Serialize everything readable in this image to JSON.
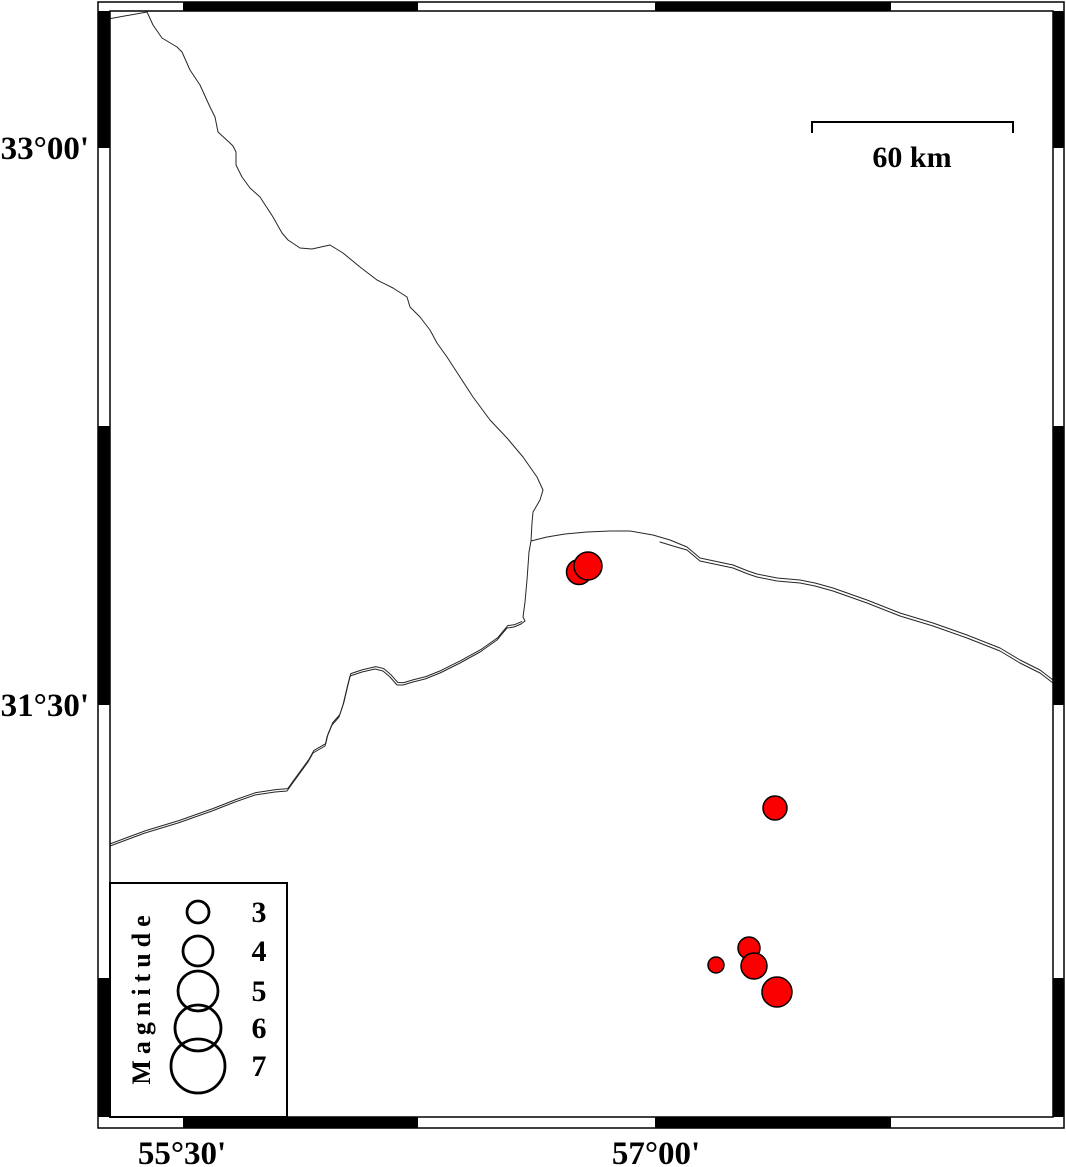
{
  "map": {
    "width": 1066,
    "height": 1167,
    "background": "#ffffff",
    "frame": {
      "outer": {
        "x": 98,
        "y": 2,
        "w": 966,
        "h": 1126
      },
      "inner": {
        "x": 110,
        "y": 11,
        "w": 943,
        "h": 1106
      },
      "top_black_segments": [
        [
          183,
          418
        ],
        [
          655,
          891
        ]
      ],
      "bottom_black_segments": [
        [
          183,
          418
        ],
        [
          655,
          891
        ]
      ],
      "left_black_segments": [
        [
          11,
          148
        ],
        [
          426,
          705
        ],
        [
          978,
          1117
        ]
      ],
      "right_black_segments": [
        [
          11,
          148
        ],
        [
          426,
          705
        ],
        [
          978,
          1117
        ]
      ]
    },
    "axes": {
      "left_labels": [
        {
          "label": "33°00'",
          "y": 148
        },
        {
          "label": "31°30'",
          "y": 705
        }
      ],
      "bottom_labels": [
        {
          "label": "55°30'",
          "x": 182
        },
        {
          "label": "57°00'",
          "x": 656
        }
      ]
    },
    "scalebar": {
      "label": "60 km",
      "x1": 812,
      "x2": 1013,
      "y": 122,
      "tick_len": 11,
      "label_x": 912,
      "label_y": 167
    },
    "legend": {
      "title": "Magnitude",
      "box": {
        "x": 110,
        "y": 883,
        "w": 177,
        "h": 234
      },
      "title_x": 150,
      "title_y": 997,
      "circle_cx": 198,
      "value_x": 259,
      "entries": [
        {
          "label": "3",
          "cy": 912,
          "r": 11
        },
        {
          "label": "4",
          "cy": 951,
          "r": 15
        },
        {
          "label": "5",
          "cy": 991,
          "r": 20
        },
        {
          "label": "6",
          "cy": 1028,
          "r": 23
        },
        {
          "label": "7",
          "cy": 1066,
          "r": 27
        }
      ]
    },
    "events": {
      "fill_color": "#fb0000",
      "outline_color": "#000000",
      "points": [
        {
          "x": 579,
          "y": 572,
          "r": 12.5
        },
        {
          "x": 588,
          "y": 566,
          "r": 14
        },
        {
          "x": 775,
          "y": 808,
          "r": 12
        },
        {
          "x": 716,
          "y": 965,
          "r": 8
        },
        {
          "x": 749,
          "y": 948,
          "r": 11
        },
        {
          "x": 754,
          "y": 966,
          "r": 13
        },
        {
          "x": 777,
          "y": 992,
          "r": 15
        }
      ]
    },
    "coastlines": {
      "color": "#262626",
      "paths": [
        {
          "name": "boundary-northwest",
          "points": [
            [
              108,
              19
            ],
            [
              147,
              12
            ],
            [
              153,
              25
            ],
            [
              162,
              38
            ],
            [
              177,
              47
            ],
            [
              182,
              52
            ],
            [
              190,
              70
            ],
            [
              200,
              85
            ],
            [
              210,
              107
            ],
            [
              215,
              117
            ],
            [
              218,
              132
            ],
            [
              230,
              143
            ],
            [
              233,
              146
            ],
            [
              236,
              152
            ],
            [
              236,
              165
            ],
            [
              242,
              177
            ],
            [
              250,
              188
            ],
            [
              260,
              197
            ],
            [
              273,
              217
            ],
            [
              282,
              233
            ],
            [
              288,
              240
            ],
            [
              300,
              248
            ],
            [
              312,
              249
            ],
            [
              330,
              245
            ],
            [
              343,
              253
            ],
            [
              360,
              267
            ],
            [
              377,
              280
            ],
            [
              393,
              288
            ],
            [
              407,
              297
            ],
            [
              410,
              307
            ],
            [
              420,
              317
            ],
            [
              430,
              330
            ],
            [
              437,
              343
            ],
            [
              447,
              357
            ],
            [
              460,
              377
            ],
            [
              473,
              397
            ],
            [
              490,
              420
            ],
            [
              507,
              438
            ],
            [
              523,
              457
            ],
            [
              537,
              477
            ],
            [
              543,
              490
            ],
            [
              540,
              500
            ],
            [
              533,
              512
            ],
            [
              532,
              523
            ],
            [
              531,
              541
            ],
            [
              529,
              552
            ],
            [
              527,
              580
            ],
            [
              525,
              602
            ],
            [
              523,
              617
            ],
            [
              525,
              621
            ],
            [
              521,
              624
            ]
          ]
        },
        {
          "name": "coast-southwest",
          "twin_offset": [
            0.8,
            -2.4
          ],
          "points": [
            [
              521,
              624
            ],
            [
              514,
              627
            ],
            [
              507,
              628
            ],
            [
              497,
              640
            ],
            [
              480,
              652
            ],
            [
              460,
              663
            ],
            [
              440,
              673
            ],
            [
              425,
              679
            ],
            [
              413,
              682
            ],
            [
              403,
              685
            ],
            [
              397,
              685
            ],
            [
              390,
              677
            ],
            [
              383,
              671
            ],
            [
              375,
              669
            ],
            [
              362,
              672
            ],
            [
              350,
              676
            ],
            [
              347,
              688
            ],
            [
              343,
              705
            ],
            [
              339,
              717
            ],
            [
              332,
              725
            ],
            [
              327,
              737
            ],
            [
              325,
              746
            ],
            [
              313,
              753
            ],
            [
              308,
              762
            ],
            [
              300,
              773
            ],
            [
              292,
              784
            ],
            [
              287,
              791
            ],
            [
              275,
              792
            ],
            [
              255,
              795
            ],
            [
              235,
              802
            ],
            [
              212,
              811
            ],
            [
              178,
              823
            ],
            [
              145,
              833
            ],
            [
              110,
              846
            ]
          ]
        },
        {
          "name": "coast-east",
          "points": [
            [
              531,
              541
            ],
            [
              547,
              537
            ],
            [
              565,
              534
            ],
            [
              587,
              532
            ],
            [
              610,
              531
            ],
            [
              630,
              531
            ],
            [
              653,
              535
            ],
            [
              670,
              540
            ],
            [
              687,
              547
            ],
            [
              700,
              558
            ],
            [
              733,
              565
            ],
            [
              748,
              571
            ],
            [
              757,
              574
            ],
            [
              777,
              578
            ],
            [
              800,
              580
            ],
            [
              815,
              583
            ],
            [
              833,
              588
            ],
            [
              850,
              594
            ],
            [
              867,
              600
            ],
            [
              900,
              613
            ],
            [
              933,
              623
            ],
            [
              967,
              635
            ],
            [
              1000,
              648
            ],
            [
              1020,
              660
            ],
            [
              1040,
              670
            ],
            [
              1053,
              680
            ]
          ]
        },
        {
          "name": "coast-east-twin",
          "points": [
            [
              660,
              542
            ],
            [
              673,
              546
            ],
            [
              687,
              550
            ],
            [
              700,
              561
            ],
            [
              733,
              568
            ],
            [
              748,
              574
            ],
            [
              757,
              577
            ],
            [
              777,
              581
            ],
            [
              800,
              583
            ],
            [
              815,
              586
            ],
            [
              833,
              591
            ],
            [
              850,
              597
            ],
            [
              867,
              603
            ],
            [
              900,
              616
            ],
            [
              933,
              626
            ],
            [
              967,
              638
            ],
            [
              1000,
              651
            ],
            [
              1020,
              663
            ],
            [
              1040,
              673
            ],
            [
              1053,
              683
            ]
          ]
        }
      ]
    }
  }
}
